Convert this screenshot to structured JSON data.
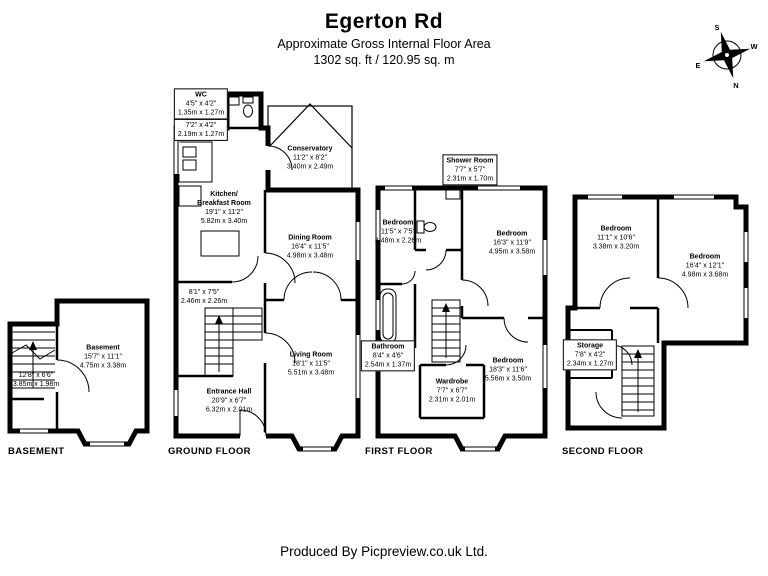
{
  "header": {
    "title": "Egerton Rd",
    "subtitle": "Approximate Gross Internal Floor Area",
    "area": "1302 sq. ft / 120.95 sq. m"
  },
  "compass": {
    "top": "S",
    "right": "W",
    "bottom": "N",
    "left": "E"
  },
  "floors": {
    "basement": {
      "label": "BASEMENT",
      "rooms": [
        {
          "name": "Basement",
          "imperial": "15'7\" x 11'1\"",
          "metric": "4.75m x 3.38m"
        },
        {
          "name": "",
          "imperial": "12'8\" x 6'6\"",
          "metric": "3.85m x 1.98m"
        }
      ]
    },
    "ground": {
      "label": "GROUND FLOOR",
      "rooms": [
        {
          "name": "WC",
          "imperial": "4'5\" x 4'2\"",
          "metric": "1.35m x 1.27m"
        },
        {
          "name": "",
          "imperial": "7'2\" x 4'2\"",
          "metric": "2.19m x 1.27m"
        },
        {
          "name": "Conservatory",
          "imperial": "11'2\" x 8'2\"",
          "metric": "3.40m x 2.49m"
        },
        {
          "name": "Kitchen/",
          "name2": "Breakfast Room",
          "imperial": "19'1\" x 11'2\"",
          "metric": "5.82m x 3.40m"
        },
        {
          "name": "Dining Room",
          "imperial": "16'4\" x 11'5\"",
          "metric": "4.98m x 3.48m"
        },
        {
          "name": "",
          "imperial": "8'1\" x 7'5\"",
          "metric": "2.46m x 2.26m"
        },
        {
          "name": "Living Room",
          "imperial": "18'1\" x 11'5\"",
          "metric": "5.51m x 3.48m"
        },
        {
          "name": "Entrance Hall",
          "imperial": "20'9\" x 6'7\"",
          "metric": "6.32m x 2.01m"
        }
      ]
    },
    "first": {
      "label": "FIRST FLOOR",
      "rooms": [
        {
          "name": "Shower Room",
          "imperial": "7'7\" x 5'7\"",
          "metric": "2.31m x 1.70m"
        },
        {
          "name": "Bedroom",
          "imperial": "11'5\" x 7'5\"",
          "metric": "3.48m x 2.26m"
        },
        {
          "name": "Bedroom",
          "imperial": "16'3\" x 11'9\"",
          "metric": "4.95m x 3.58m"
        },
        {
          "name": "Bathroom",
          "imperial": "8'4\" x 4'6\"",
          "metric": "2.54m x 1.37m"
        },
        {
          "name": "Wardrobe",
          "imperial": "7'7\" x 6'7\"",
          "metric": "2.31m x 2.01m"
        },
        {
          "name": "Bedroom",
          "imperial": "18'3\" x 11'6\"",
          "metric": "5.56m x 3.50m"
        }
      ]
    },
    "second": {
      "label": "SECOND FLOOR",
      "rooms": [
        {
          "name": "Bedroom",
          "imperial": "11'1\" x 10'6\"",
          "metric": "3.38m x 3.20m"
        },
        {
          "name": "Bedroom",
          "imperial": "16'4\" x 12'1\"",
          "metric": "4.98m x 3.68m"
        },
        {
          "name": "Storage",
          "imperial": "7'8\" x 4'2\"",
          "metric": "2.34m x 1.27m"
        }
      ]
    }
  },
  "footer": {
    "credit": "Produced By Picpreview.co.uk Ltd."
  },
  "colors": {
    "ink": "#000000",
    "paper": "#ffffff"
  }
}
